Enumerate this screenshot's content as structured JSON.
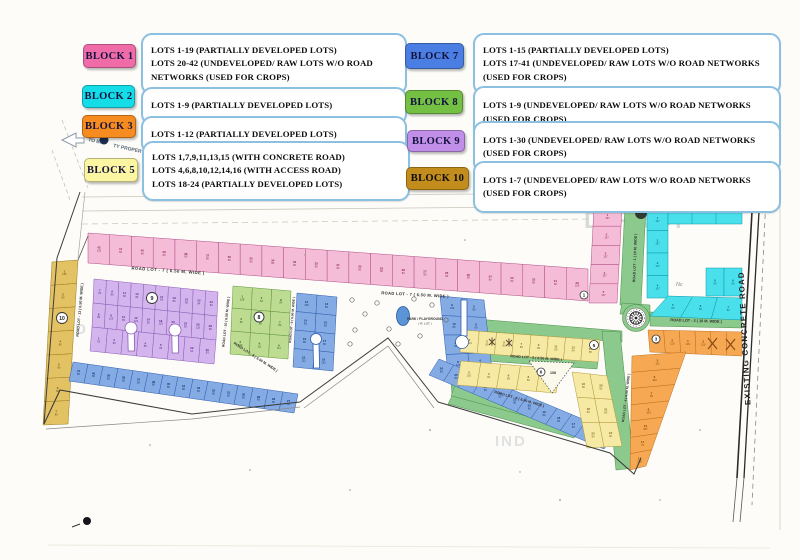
{
  "legend": {
    "left": [
      {
        "id": "block-1",
        "label": "BLOCK 1",
        "color": "#ef6ca9",
        "lines": [
          "LOTS 1-19  (PARTIALLY DEVELOPED LOTS)",
          "LOTS 20-42 (UNDEVELOPED/ RAW LOTS W/O ROAD",
          "NETWORKS (USED FOR CROPS)"
        ]
      },
      {
        "id": "block-2",
        "label": "BLOCK 2",
        "color": "#14dde8",
        "lines": [
          "LOTS 1-9   (PARTIALLY DEVELOPED LOTS)"
        ]
      },
      {
        "id": "block-3",
        "label": "BLOCK 3",
        "color": "#f68b1f",
        "lines": [
          "LOTS 1-12  (PARTIALLY DEVELOPED LOTS)"
        ]
      },
      {
        "id": "block-5",
        "label": "BLOCK 5",
        "color": "#fcf6a2",
        "lines": [
          "LOTS 1,7,9,11,13,15 (WITH CONCRETE ROAD)",
          "LOTS 4,6,8,10,12,14,16 (WITH ACCESS ROAD)",
          "LOTS 18-24 (PARTIALLY DEVELOPED LOTS)"
        ]
      }
    ],
    "right": [
      {
        "id": "block-7",
        "label": "BLOCK 7",
        "color": "#4b7ee2",
        "lines": [
          "LOTS 1-15  (PARTIALLY DEVELOPED LOTS)",
          "LOTS 17-41 (UNDEVELOPED/ RAW LOTS W/O ROAD NETWORKS",
          "(USED FOR CROPS)"
        ]
      },
      {
        "id": "block-8",
        "label": "BLOCK 8",
        "color": "#74c043",
        "lines": [
          "LOTS 1-9 (UNDEVELOPED/ RAW LOTS W/O ROAD NETWORKS",
          "(USED FOR CROPS)"
        ]
      },
      {
        "id": "block-9",
        "label": "BLOCK 9",
        "color": "#c18fe8",
        "lines": [
          "LOTS 1-30 (UNDEVELOPED/ RAW LOTS W/O ROAD NETWORKS",
          "(USED FOR CROPS)"
        ]
      },
      {
        "id": "block-10",
        "label": "BLOCK 10",
        "color": "#c28d1d",
        "lines": [
          "LOTS 1-7 (UNDEVELOPED/ RAW LOTS W/O ROAD NETWORKS",
          "(USED FOR CROPS)"
        ]
      }
    ]
  },
  "map": {
    "palette": {
      "pink": [
        "#f5bcd7",
        "#b04d86",
        "#8c2a56"
      ],
      "gold": [
        "#e3c264",
        "#9a7c20",
        "#6b5210"
      ],
      "purple": [
        "#d4b4ec",
        "#8a5cb8",
        "#5b2d8a"
      ],
      "green": [
        "#bedb92",
        "#5f9639",
        "#2f641a"
      ],
      "blue": [
        "#85abe4",
        "#2f5fae",
        "#16366e"
      ],
      "cyan": [
        "#49dfeb",
        "#0d98aa",
        "#066a78"
      ],
      "yellow": [
        "#f6e9a4",
        "#b29a3a",
        "#7a611a"
      ],
      "orange": [
        "#f6a952",
        "#c07020",
        "#7c4408"
      ],
      "road_green": "#8cc98c"
    },
    "road_labels": {
      "r7a": "ROAD LOT - 7  ( 6.50 M. WIDE )",
      "r7b": "ROAD LOT - 7  ( 6.50 M. WIDE )",
      "r13": "ROAD LOT - 13  ( 6.50 M. WIDE )",
      "r10": "ROAD LOT - 10  ( 6.50 M. WIDE )",
      "r9": "ROAD LOT - 9  ( 6.50 M. WIDE )",
      "r8": "ROAD LOT - 8  ( 6.50 M. WIDE )",
      "r1": "ROAD LOT - 1  ( 10 M. WIDE )",
      "r2": "ROAD LOT - 2  ( 10 M. WIDE )",
      "r4": "ROAD LOT - 4  ( 6.50 M. WIDE )",
      "r5": "ROAD LOT - 5  ( 6.50 M. WIDE )",
      "r6": "ROAD LOT - 6  ( 6.50 M. WIDE )",
      "existing": "EXISTING CONCRETE ROAD"
    },
    "annotations": {
      "to_proper_a": "TO BA",
      "to_proper_b": "TY PROPER",
      "l_road": "L ROAD",
      "park": "PARK / PLAYGROUND",
      "park_sub": "( R. LOT )",
      "nc": "Nc",
      "open_space_area": "108",
      "wm1": "D PROP",
      "wm2": "IND",
      "wm3": "IND"
    },
    "circled": {
      "c10": "10",
      "c9": "9",
      "c8": "8",
      "c5": "5",
      "c6": "6",
      "c3": "3",
      "c1": "1"
    },
    "lots": {
      "b1_top": [
        "42|135",
        "41|80",
        "40|80",
        "39|80",
        "38|80",
        "37|80",
        "36|80",
        "35|80",
        "34|80",
        "33|80",
        "32|80",
        "31|80",
        "30|80",
        "29|80",
        "28|80",
        "27|80",
        "26|80",
        "25|80",
        "24|80",
        "23|80",
        "22|80",
        "21|80",
        "20|105"
      ],
      "b1_side": [
        "1|137",
        "2|157",
        "3|157",
        "4|157",
        "5|157"
      ],
      "b10_col": [
        "1|126",
        "2|80",
        "3|80",
        "4|80",
        "5|80",
        "6|80",
        "7|80"
      ],
      "b9_r1": [
        "7|63",
        "9|80",
        "11|80",
        "13|83",
        "15|80",
        "17|80",
        "19|80",
        "21|80",
        "23|84",
        "24|82"
      ],
      "b9_r2": [
        "6|80",
        "8|123",
        "10|85",
        "12|123",
        "14|85",
        "18|123",
        "20|125",
        "22|80",
        "26|125",
        "28|80"
      ],
      "b9_r3": [
        "1|92",
        "2|80",
        "3|85",
        "4|85",
        "5|95",
        "16|93",
        "29|94",
        "30|93"
      ],
      "b8_r1": [
        "1|108",
        "4|84",
        "8|84"
      ],
      "b8_r2": [
        "2|80",
        "5|80",
        "7|80"
      ],
      "b8_r3": [
        "3|100",
        "6|111",
        "9|111"
      ],
      "b7_a1": [
        "12|106",
        "14|85",
        "16|85",
        "18|122"
      ],
      "b7_a2": [
        "13|80",
        "15|80",
        "17|80",
        "19|132"
      ],
      "b7_b1": [
        "9|106",
        "10|85",
        "11|85",
        "8|132"
      ],
      "b7_b2": [
        "5|80",
        "6|80",
        "7|80",
        "4|113"
      ],
      "b7_bl": [
        "41|80",
        "40|80",
        "39|80",
        "38|80",
        "37|80",
        "36|80",
        "35|80",
        "34|80",
        "33|80",
        "32|80",
        "31|80",
        "30|80",
        "29|80",
        "28|80",
        "27|80"
      ],
      "b7_br": [
        "26|80",
        "25|80",
        "24|80",
        "23|80",
        "22|80",
        "21|80",
        "20|80",
        "19|80",
        "18|80",
        "17|80",
        "16|80",
        "15|80"
      ],
      "b2_left": [
        "1|157",
        "2|157",
        "3|157",
        "4|157"
      ],
      "b2_bot": [
        "5|80",
        "6|80",
        "7|80"
      ],
      "b2_right": [
        "8|80",
        "9|80"
      ],
      "b5_r1": [
        "1|124",
        "3|80",
        "5|80",
        "7|80",
        "9|80",
        "11|80",
        "13|94",
        "15|85"
      ],
      "b5_r2": [
        "2|120",
        "4|80",
        "6|80",
        "8|80",
        "10|80"
      ],
      "b5_c1": [
        "16|80",
        "18|80",
        "22|80"
      ],
      "b5_c2": [
        "20|82",
        "21|80",
        "24|90"
      ],
      "b3_row": [
        "1|110",
        "2|110",
        "4|103",
        "3|110",
        "|",
        "|"
      ],
      "b3_col": [
        "5|112",
        "6|103",
        "7|81",
        "8|103",
        "10|207",
        "11|73",
        "12|218"
      ]
    }
  }
}
